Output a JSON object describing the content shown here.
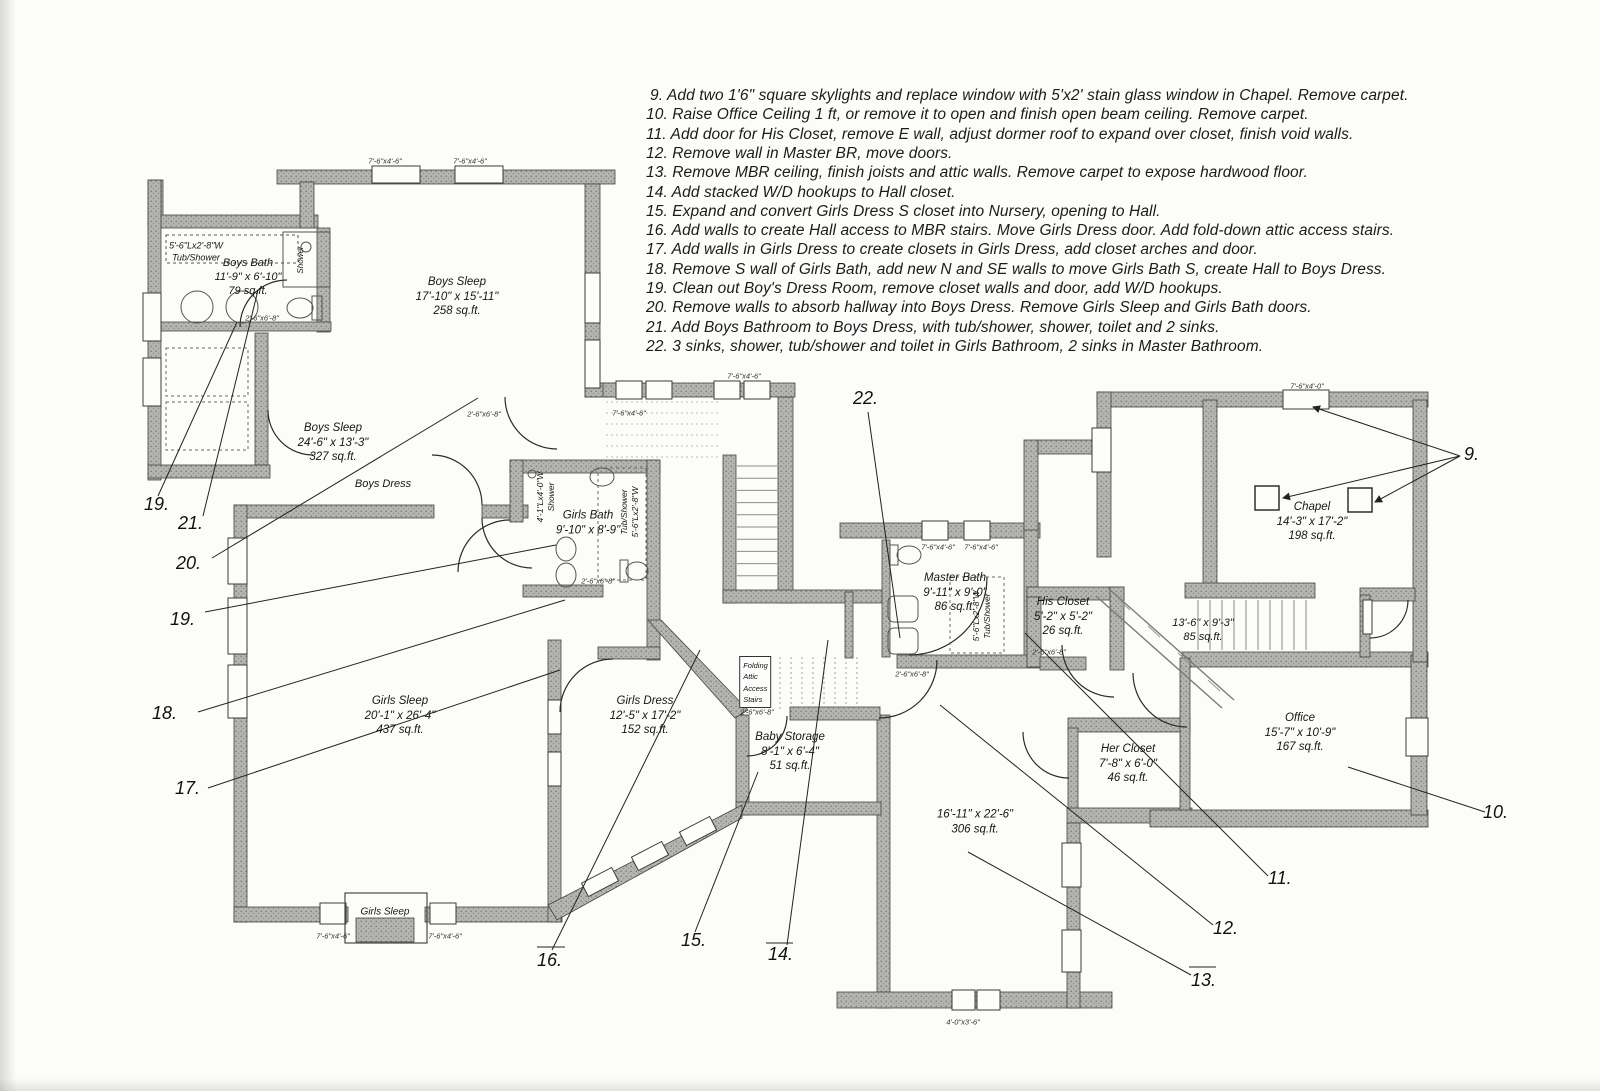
{
  "document": {
    "type": "scanned second-floor remodel plan"
  },
  "notes": {
    "x": 646,
    "top": 87,
    "line_height": 19.3,
    "items": [
      "9. Add two 1'6\" square skylights and replace window with 5'x2' stain glass window in Chapel. Remove carpet.",
      "10. Raise Office Ceiling 1 ft, or remove it to open and finish open beam ceiling. Remove carpet.",
      "11. Add door for His Closet, remove E wall, adjust dormer roof to expand over closet, finish void walls.",
      "12. Remove wall in Master BR, move doors.",
      "13. Remove MBR ceiling, finish joists and attic walls. Remove carpet to expose hardwood floor.",
      "14. Add stacked W/D hookups to Hall closet.",
      "15. Expand and convert Girls Dress S closet into Nursery, opening to Hall.",
      "16. Add walls to create Hall access to MBR stairs. Move Girls Dress door. Add fold-down attic access stairs.",
      "17. Add walls in Girls Dress to create closets in Girls Dress, add closet arches and door.",
      "18. Remove S wall of Girls Bath, add new N and SE walls to move Girls Bath S, create Hall to Boys Dress.",
      "19. Clean out Boy's Dress Room, remove closet walls and door, add W/D hookups.",
      "20. Remove walls to absorb hallway into Boys Dress. Remove Girls Sleep and Girls Bath doors.",
      "21. Add Boys Bathroom to Boys Dress, with tub/shower, shower, toilet and 2 sinks.",
      "22. 3 sinks, shower, tub/shower and toilet in Girls Bathroom, 2 sinks in Master Bathroom."
    ]
  },
  "room_labels": [
    {
      "id": "boys-bath-tub",
      "lines": [
        "5'-6\"Lx2'-8\"W",
        "Tub/Shower"
      ],
      "x": 196,
      "y": 252,
      "fs": 9
    },
    {
      "id": "boys-bath",
      "lines": [
        "Boys Bath",
        "11'-9\" x 6'-10\"",
        "79 sq.ft."
      ],
      "x": 248,
      "y": 277,
      "fs": 11
    },
    {
      "id": "boys-shower",
      "lines": [
        "Shower"
      ],
      "x": 301,
      "y": 260,
      "fs": 8,
      "rot": true
    },
    {
      "id": "boys-sleep-1",
      "lines": [
        "Boys Sleep",
        "17'-10\" x 15'-11\"",
        "258 sq.ft."
      ],
      "x": 457,
      "y": 297,
      "fs": 11.5
    },
    {
      "id": "boys-sleep-2",
      "lines": [
        "Boys Sleep",
        "24'-6\" x 13'-3\"",
        "327 sq.ft."
      ],
      "x": 333,
      "y": 443,
      "fs": 11.5
    },
    {
      "id": "boys-dress",
      "lines": [
        "Boys Dress"
      ],
      "x": 383,
      "y": 484,
      "fs": 11
    },
    {
      "id": "girls-bath",
      "lines": [
        "Girls Bath",
        "9'-10\" x 8'-9\""
      ],
      "x": 588,
      "y": 523,
      "fs": 11.5
    },
    {
      "id": "girls-shower",
      "lines": [
        "4'-1\"Lx4'-0\"W",
        "Shower"
      ],
      "x": 546,
      "y": 497,
      "fs": 8.5,
      "rot": true
    },
    {
      "id": "girls-tub",
      "lines": [
        "Tub/Shower",
        "5'-6\"Lx2'-8\"W"
      ],
      "x": 630,
      "y": 512,
      "fs": 8.5,
      "rot": true
    },
    {
      "id": "girls-sleep",
      "lines": [
        "Girls Sleep",
        "20'-1\" x 26'-4\"",
        "437 sq.ft."
      ],
      "x": 400,
      "y": 716,
      "fs": 11.5
    },
    {
      "id": "girls-dress",
      "lines": [
        "Girls Dress",
        "12'-5\" x 17'-2\"",
        "152 sq.ft."
      ],
      "x": 645,
      "y": 716,
      "fs": 11.5
    },
    {
      "id": "folding-attic-stairs",
      "lines": [
        "Folding",
        "Attic",
        "Access",
        "Stairs"
      ],
      "x": 755,
      "y": 682,
      "fs": 7.5,
      "boxed": true
    },
    {
      "id": "baby-storage",
      "lines": [
        "Baby Storage",
        "8'-1\" x 6'-4\"",
        "51 sq.ft."
      ],
      "x": 790,
      "y": 752,
      "fs": 11.5
    },
    {
      "id": "master-bath",
      "lines": [
        "Master Bath",
        "9'-11\" x 9'-0\"",
        "86 sq.ft."
      ],
      "x": 955,
      "y": 593,
      "fs": 11.5
    },
    {
      "id": "master-tub",
      "lines": [
        "5'-6\"Lx2'-8\"W",
        "Tub/Shower"
      ],
      "x": 982,
      "y": 616,
      "fs": 8.5,
      "rot": true
    },
    {
      "id": "his-closet",
      "lines": [
        "His Closet",
        "5'-2\" x 5'-2\"",
        "26 sq.ft."
      ],
      "x": 1063,
      "y": 617,
      "fs": 11.5
    },
    {
      "id": "mbr-stairs",
      "lines": [
        "13'-6\" x 9'-3\"",
        "85 sq.ft."
      ],
      "x": 1203,
      "y": 630,
      "fs": 11
    },
    {
      "id": "chapel",
      "lines": [
        "Chapel",
        "14'-3\" x 17'-2\"",
        "198 sq.ft."
      ],
      "x": 1312,
      "y": 522,
      "fs": 11.5
    },
    {
      "id": "office",
      "lines": [
        "Office",
        "15'-7\" x 10'-9\"",
        "167 sq.ft."
      ],
      "x": 1300,
      "y": 733,
      "fs": 11.5
    },
    {
      "id": "her-closet",
      "lines": [
        "Her Closet",
        "7'-8\" x 6'-0\"",
        "46 sq.ft."
      ],
      "x": 1128,
      "y": 764,
      "fs": 11.5
    },
    {
      "id": "master-br",
      "lines": [
        "16'-11\" x 22'-6\"",
        "306 sq.ft."
      ],
      "x": 975,
      "y": 822,
      "fs": 11.5
    },
    {
      "id": "girls-sleep-bay",
      "lines": [
        "Girls Sleep"
      ],
      "x": 385,
      "y": 913,
      "fs": 10
    }
  ],
  "callouts": [
    {
      "label": "9.",
      "x": 1464,
      "y": 444
    },
    {
      "label": "10.",
      "x": 1483,
      "y": 802
    },
    {
      "label": "11.",
      "x": 1268,
      "y": 868
    },
    {
      "label": "12.",
      "x": 1213,
      "y": 918
    },
    {
      "label": "13.",
      "x": 1191,
      "y": 970
    },
    {
      "label": "14.",
      "x": 768,
      "y": 944
    },
    {
      "label": "15.",
      "x": 681,
      "y": 930
    },
    {
      "label": "16.",
      "x": 537,
      "y": 950
    },
    {
      "label": "17.",
      "x": 175,
      "y": 778
    },
    {
      "label": "18.",
      "x": 152,
      "y": 703
    },
    {
      "label": "19.",
      "x": 144,
      "y": 494
    },
    {
      "label": "19.",
      "x": 170,
      "y": 609
    },
    {
      "label": "20.",
      "x": 176,
      "y": 553
    },
    {
      "label": "21.",
      "x": 178,
      "y": 513
    },
    {
      "label": "22.",
      "x": 853,
      "y": 388
    }
  ],
  "window_tags": [
    {
      "text": "7'-6\"x4'-6\"",
      "x": 385,
      "y": 161
    },
    {
      "text": "7'-6\"x4'-6\"",
      "x": 470,
      "y": 161
    },
    {
      "text": "7'-6\"x4'-6\"",
      "x": 629,
      "y": 413
    },
    {
      "text": "7'-6\"x4'-6\"",
      "x": 744,
      "y": 376
    },
    {
      "text": "7'-6\"x4'-6\"",
      "x": 938,
      "y": 547
    },
    {
      "text": "7'-6\"x4'-6\"",
      "x": 981,
      "y": 547
    },
    {
      "text": "7'-6\"x4'-6\"",
      "x": 333,
      "y": 936
    },
    {
      "text": "7'-6\"x4'-6\"",
      "x": 445,
      "y": 936
    },
    {
      "text": "4'-0\"x3'-6\"",
      "x": 963,
      "y": 1022
    },
    {
      "text": "7'-6\"x4'-0\"",
      "x": 1307,
      "y": 386
    },
    {
      "text": "2'-6\"x6'-8\"",
      "x": 262,
      "y": 318
    },
    {
      "text": "2'-6\"x6'-8\"",
      "x": 484,
      "y": 414
    },
    {
      "text": "2'-6\"x6'-8\"",
      "x": 598,
      "y": 581
    },
    {
      "text": "2'-6\"x6'-8\"",
      "x": 912,
      "y": 674
    },
    {
      "text": "2'-6\"x6'-8\"",
      "x": 757,
      "y": 712
    },
    {
      "text": "2'-6\"x6'-8\"",
      "x": 1049,
      "y": 652
    }
  ],
  "colors": {
    "wall_fill": "#b4b4b0",
    "wall_dot": "#787872",
    "wall_edge": "#45453f",
    "line": "#2b2b28",
    "text": "#161616",
    "background": "#fcfcfa"
  }
}
